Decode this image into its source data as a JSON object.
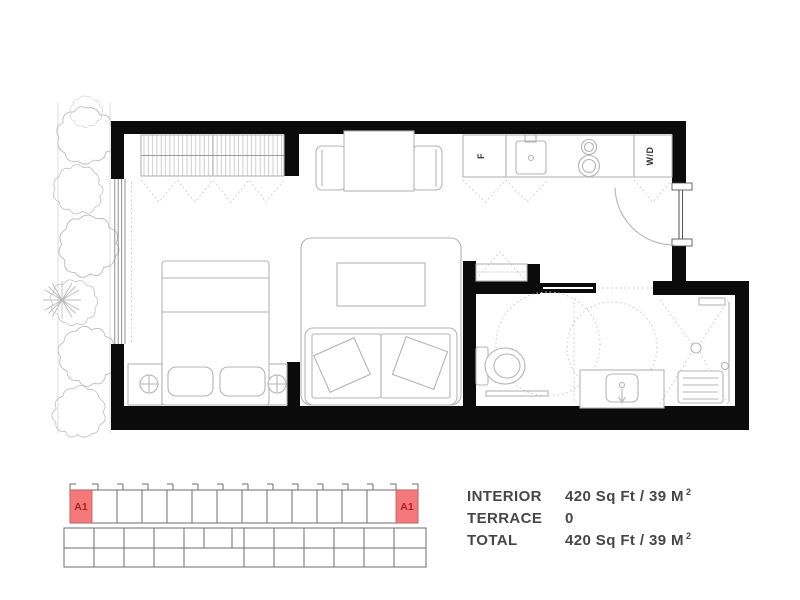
{
  "floor_plan": {
    "labels": {
      "fridge": "F",
      "washer_dryer": "W/D"
    },
    "colors": {
      "wall": "#0b0b0b",
      "furniture_line": "#b4b4b4",
      "dotted_line": "#cbcbcb"
    }
  },
  "key_plan": {
    "unit_left_label": "A1",
    "unit_right_label": "A1",
    "highlight_color": "#f4797b",
    "highlight_text_color": "#b11f1f",
    "outline_color": "#6e6e6e"
  },
  "stats": {
    "text_color": "#464646",
    "rows": [
      {
        "label": "INTERIOR",
        "value": "420 Sq Ft / 39 M",
        "sup": "2"
      },
      {
        "label": "TERRACE",
        "value": "0",
        "sup": ""
      },
      {
        "label": "TOTAL",
        "value": "420 Sq Ft / 39 M",
        "sup": "2"
      }
    ]
  }
}
